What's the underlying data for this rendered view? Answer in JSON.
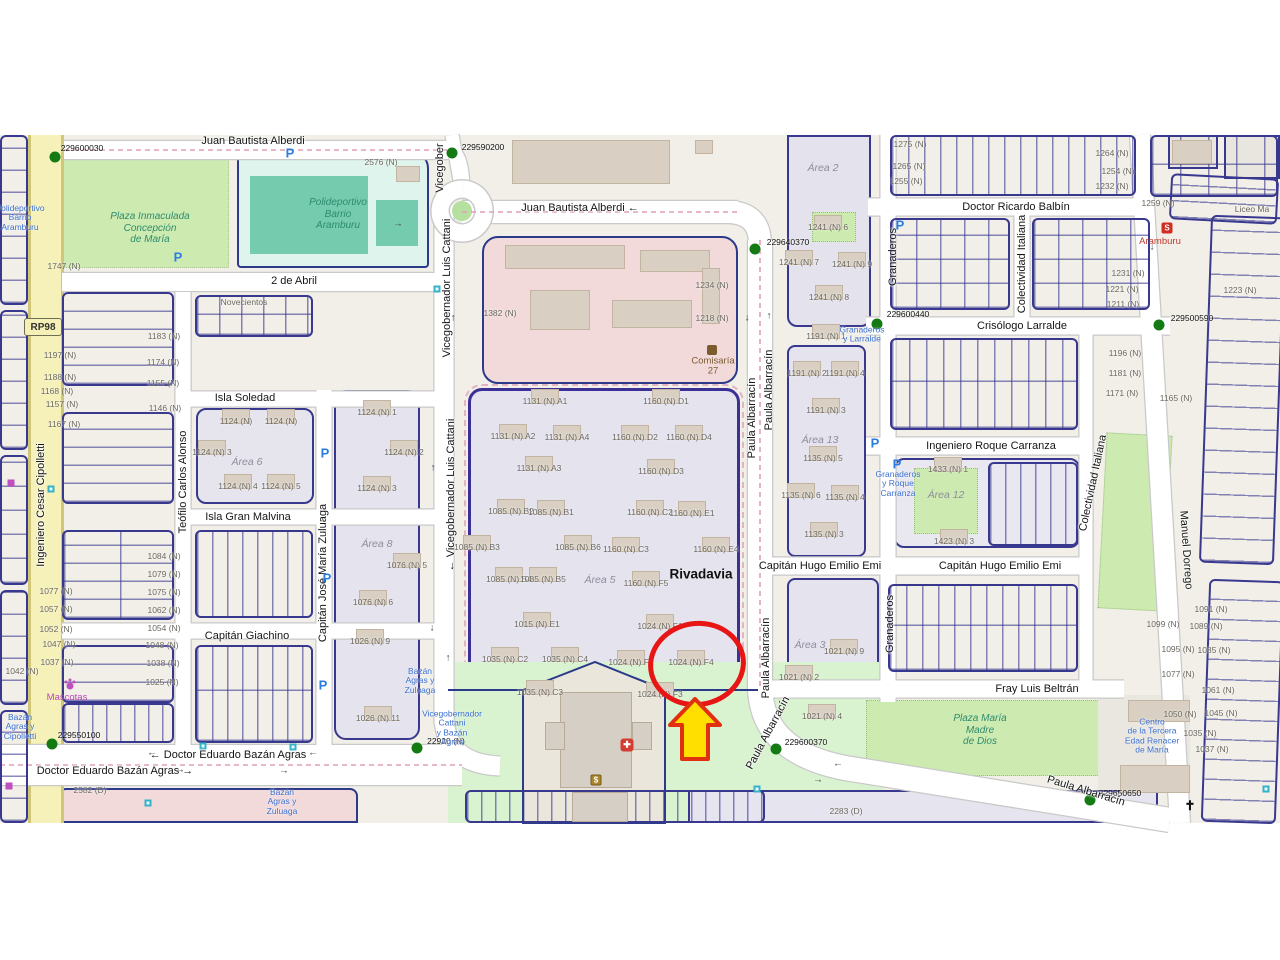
{
  "map": {
    "route_ref": "RP98",
    "highlighted_parcel": "1024 (N) F4",
    "colors": {
      "highlight_red": "#e81515",
      "arrow_yellow": "#ffdf00",
      "arrow_border": "#e03010",
      "marker_green": "#147a14",
      "bus_blue": "#3a6fd0",
      "park_green": "#cdebb0",
      "cadastral_navy": "#39388f",
      "road_yellow": "#f5f1b8"
    }
  },
  "labels": {
    "streets": [
      {
        "t": "Juan Bautista Alberdi",
        "x": 253,
        "y": 141
      },
      {
        "t": "Juan Bautista Alberdi ←",
        "x": 580,
        "y": 208
      },
      {
        "t": "2 de Abril",
        "x": 294,
        "y": 281
      },
      {
        "t": "Isla Soledad",
        "x": 245,
        "y": 398
      },
      {
        "t": "Isla Gran Malvina",
        "x": 248,
        "y": 517
      },
      {
        "t": "Capitán Giachino",
        "x": 247,
        "y": 636
      },
      {
        "t": "← Doctor Eduardo Bazán Agras",
        "x": 228,
        "y": 755
      },
      {
        "t": "Doctor Eduardo Bazán Agras →",
        "x": 115,
        "y": 771
      },
      {
        "t": "Doctor Ricardo Balbín",
        "x": 1016,
        "y": 207
      },
      {
        "t": "Crisólogo Larralde",
        "x": 1022,
        "y": 326
      },
      {
        "t": "Ingeniero Roque Carranza",
        "x": 991,
        "y": 446
      },
      {
        "t": "Capitán Hugo Emilio Emi",
        "x": 820,
        "y": 566
      },
      {
        "t": "Capitán Hugo Emilio Emi",
        "x": 1000,
        "y": 566
      },
      {
        "t": "Fray Luis Beltrán",
        "x": 1037,
        "y": 689
      },
      {
        "t": "Vicegober",
        "x": 440,
        "y": 168,
        "r": -90
      },
      {
        "t": "Vicegobernador Luis Cattani",
        "x": 447,
        "y": 288,
        "r": -90
      },
      {
        "t": "← Vicegobernador Luis Cattani",
        "x": 451,
        "y": 495,
        "r": -90
      },
      {
        "t": "Teófilo Carlos Alonso",
        "x": 183,
        "y": 482,
        "r": -90
      },
      {
        "t": "Capitán José María Zuluaga",
        "x": 323,
        "y": 573,
        "r": -90
      },
      {
        "t": "Paula Albarracín",
        "x": 752,
        "y": 418,
        "r": -90
      },
      {
        "t": "Paula Albarracín",
        "x": 769,
        "y": 390,
        "r": -90
      },
      {
        "t": "Paula Albarracín",
        "x": 766,
        "y": 658,
        "r": -90
      },
      {
        "t": "Paula Albarracín",
        "x": 768,
        "y": 733,
        "r": -62
      },
      {
        "t": "Paula Albarracín",
        "x": 1086,
        "y": 791,
        "r": 17
      },
      {
        "t": "Granaderos",
        "x": 893,
        "y": 257,
        "r": -90
      },
      {
        "t": "Granaderos",
        "x": 890,
        "y": 624,
        "r": -90
      },
      {
        "t": "Colectividad Italiana",
        "x": 1022,
        "y": 264,
        "r": -90
      },
      {
        "t": "Colectividad Italiana",
        "x": 1093,
        "y": 483,
        "r": -78
      },
      {
        "t": "Manuel Dorrego",
        "x": 1186,
        "y": 550,
        "r": 86
      },
      {
        "t": "Ingeniero Cesar Cipolletti",
        "x": 41,
        "y": 505,
        "r": -90
      }
    ],
    "minor": [
      {
        "t": "2576 (N)",
        "x": 381,
        "y": 162
      },
      {
        "t": "1747 (N)",
        "x": 64,
        "y": 266
      },
      {
        "t": "1382 (N)",
        "x": 500,
        "y": 313
      },
      {
        "t": "1234 (N)",
        "x": 712,
        "y": 285
      },
      {
        "t": "1218 (N)",
        "x": 712,
        "y": 318
      },
      {
        "t": "1275 (N)",
        "x": 910,
        "y": 144
      },
      {
        "t": "1265 (N)",
        "x": 909,
        "y": 166
      },
      {
        "t": "1255 (N)",
        "x": 906,
        "y": 181
      },
      {
        "t": "1264 (N)",
        "x": 1112,
        "y": 153
      },
      {
        "t": "1254 (N)",
        "x": 1118,
        "y": 171
      },
      {
        "t": "1232 (N)",
        "x": 1112,
        "y": 186
      },
      {
        "t": "1259 (N)",
        "x": 1158,
        "y": 203
      },
      {
        "t": "1241 (N) 6",
        "x": 828,
        "y": 227,
        "b": 1
      },
      {
        "t": "1241 (N) 7",
        "x": 799,
        "y": 262,
        "b": 1
      },
      {
        "t": "1241 (N) 9",
        "x": 852,
        "y": 264,
        "b": 1
      },
      {
        "t": "1241 (N) 8",
        "x": 829,
        "y": 297,
        "b": 1
      },
      {
        "t": "1231 (N)",
        "x": 1128,
        "y": 273
      },
      {
        "t": "1221 (N)",
        "x": 1122,
        "y": 289
      },
      {
        "t": "1223 (N)",
        "x": 1240,
        "y": 290
      },
      {
        "t": "1211 (N)",
        "x": 1123,
        "y": 304
      },
      {
        "t": "1196 (N)",
        "x": 1125,
        "y": 353
      },
      {
        "t": "1181 (N)",
        "x": 1125,
        "y": 373
      },
      {
        "t": "1171 (N)",
        "x": 1122,
        "y": 393
      },
      {
        "t": "1165 (N)",
        "x": 1176,
        "y": 398
      },
      {
        "t": "1197 (N)",
        "x": 60,
        "y": 355
      },
      {
        "t": "1188 (N)",
        "x": 60,
        "y": 377
      },
      {
        "t": "1168 (N)",
        "x": 57,
        "y": 391
      },
      {
        "t": "1157 (N)",
        "x": 62,
        "y": 404
      },
      {
        "t": "1167 (N)",
        "x": 64,
        "y": 424
      },
      {
        "t": "1183 (N)",
        "x": 164,
        "y": 336
      },
      {
        "t": "1174 (N)",
        "x": 163,
        "y": 362
      },
      {
        "t": "1155 (N)",
        "x": 163,
        "y": 383
      },
      {
        "t": "1146 (N)",
        "x": 165,
        "y": 408
      },
      {
        "t": "1077 (N)",
        "x": 56,
        "y": 591
      },
      {
        "t": "1057 (N)",
        "x": 56,
        "y": 609
      },
      {
        "t": "1052 (N)",
        "x": 56,
        "y": 629
      },
      {
        "t": "1047 (N)",
        "x": 59,
        "y": 644
      },
      {
        "t": "1037 (N)",
        "x": 57,
        "y": 662
      },
      {
        "t": "1042 (N)",
        "x": 22,
        "y": 671
      },
      {
        "t": "1084 (N)",
        "x": 164,
        "y": 556
      },
      {
        "t": "1079 (N)",
        "x": 164,
        "y": 574
      },
      {
        "t": "1075 (N)",
        "x": 164,
        "y": 592
      },
      {
        "t": "1062 (N)",
        "x": 164,
        "y": 610
      },
      {
        "t": "1054 (N)",
        "x": 164,
        "y": 628
      },
      {
        "t": "1048 (N)",
        "x": 162,
        "y": 645
      },
      {
        "t": "1038 (N)",
        "x": 163,
        "y": 663
      },
      {
        "t": "1025 (N)",
        "x": 162,
        "y": 682
      },
      {
        "t": "Novecientos",
        "x": 244,
        "y": 302
      },
      {
        "t": "1124 (N)",
        "x": 236,
        "y": 421,
        "b": 1
      },
      {
        "t": "1124 (N)",
        "x": 281,
        "y": 421,
        "b": 1
      },
      {
        "t": "1124 (N) 3",
        "x": 212,
        "y": 452,
        "b": 1
      },
      {
        "t": "1124 (N) 4",
        "x": 238,
        "y": 486,
        "b": 1
      },
      {
        "t": "1124 (N) 5",
        "x": 281,
        "y": 486,
        "b": 1
      },
      {
        "t": "1124 (N) 1",
        "x": 377,
        "y": 412,
        "b": 1
      },
      {
        "t": "1124 (N) 2",
        "x": 404,
        "y": 452,
        "b": 1
      },
      {
        "t": "1124 (N) 3",
        "x": 377,
        "y": 488,
        "b": 1
      },
      {
        "t": "1076 (N) 5",
        "x": 407,
        "y": 565,
        "b": 1
      },
      {
        "t": "1076 (N) 6",
        "x": 373,
        "y": 602,
        "b": 1
      },
      {
        "t": "1026 (N) 9",
        "x": 370,
        "y": 641,
        "b": 1
      },
      {
        "t": "1026 (N) 11",
        "x": 378,
        "y": 718,
        "b": 1
      },
      {
        "t": "1131 (N) A1",
        "x": 545,
        "y": 401,
        "b": 1
      },
      {
        "t": "1160 (N) D1",
        "x": 666,
        "y": 401,
        "b": 1
      },
      {
        "t": "1131 (N) A2",
        "x": 513,
        "y": 436,
        "b": 1
      },
      {
        "t": "1131 (N) A4",
        "x": 567,
        "y": 437,
        "b": 1
      },
      {
        "t": "1160 (N) D2",
        "x": 635,
        "y": 437,
        "b": 1
      },
      {
        "t": "1160 (N) D4",
        "x": 689,
        "y": 437,
        "b": 1
      },
      {
        "t": "1131 (N) A3",
        "x": 539,
        "y": 468,
        "b": 1
      },
      {
        "t": "1160 (N) D3",
        "x": 661,
        "y": 471,
        "b": 1
      },
      {
        "t": "1085 (N) B2",
        "x": 511,
        "y": 511,
        "b": 1
      },
      {
        "t": "1085 (N) B1",
        "x": 551,
        "y": 512,
        "b": 1
      },
      {
        "t": "1160 (N) C2",
        "x": 650,
        "y": 512,
        "b": 1
      },
      {
        "t": "1160 (N) E1",
        "x": 692,
        "y": 513,
        "b": 1
      },
      {
        "t": "1085 (N) B3",
        "x": 477,
        "y": 547,
        "b": 1
      },
      {
        "t": "1085 (N) B6",
        "x": 578,
        "y": 547,
        "b": 1
      },
      {
        "t": "1160 (N) C3",
        "x": 626,
        "y": 549,
        "b": 1
      },
      {
        "t": "1160 (N) E4",
        "x": 716,
        "y": 549,
        "b": 1
      },
      {
        "t": "1085 (N) B4",
        "x": 509,
        "y": 579,
        "b": 1
      },
      {
        "t": "1085 (N) B5",
        "x": 543,
        "y": 579,
        "b": 1
      },
      {
        "t": "1160 (N) F5",
        "x": 646,
        "y": 583,
        "b": 1
      },
      {
        "t": "1015 (N) E1",
        "x": 537,
        "y": 624,
        "b": 1
      },
      {
        "t": "1024 (N) F1",
        "x": 660,
        "y": 626,
        "b": 1
      },
      {
        "t": "1035 (N) C2",
        "x": 505,
        "y": 659,
        "b": 1
      },
      {
        "t": "1035 (N) C4",
        "x": 565,
        "y": 659,
        "b": 1
      },
      {
        "t": "1024 (N) F2",
        "x": 631,
        "y": 662,
        "b": 1
      },
      {
        "t": "1024 (N) F4",
        "x": 691,
        "y": 662,
        "b": 1
      },
      {
        "t": "1035 (N) C3",
        "x": 540,
        "y": 692,
        "b": 1
      },
      {
        "t": "1024 (N) F3",
        "x": 660,
        "y": 694,
        "b": 1
      },
      {
        "t": "1191 (N) 1",
        "x": 826,
        "y": 336,
        "b": 1
      },
      {
        "t": "1191 (N) 2",
        "x": 807,
        "y": 373,
        "b": 1
      },
      {
        "t": "1191 (N) 4",
        "x": 845,
        "y": 373,
        "b": 1
      },
      {
        "t": "1191 (N) 3",
        "x": 826,
        "y": 410,
        "b": 1
      },
      {
        "t": "1135 (N) 5",
        "x": 823,
        "y": 458,
        "b": 1
      },
      {
        "t": "1135 (N) 6",
        "x": 801,
        "y": 495,
        "b": 1
      },
      {
        "t": "1135 (N) 4",
        "x": 845,
        "y": 497,
        "b": 1
      },
      {
        "t": "1135 (N) 3",
        "x": 824,
        "y": 534,
        "b": 1
      },
      {
        "t": "1433 (N) 1",
        "x": 948,
        "y": 469,
        "b": 1
      },
      {
        "t": "1423 (N) 3",
        "x": 954,
        "y": 541,
        "b": 1
      },
      {
        "t": "1021 (N) 9",
        "x": 844,
        "y": 651,
        "b": 1
      },
      {
        "t": "1021 (N) 2",
        "x": 799,
        "y": 677,
        "b": 1
      },
      {
        "t": "1021 (N) 4",
        "x": 822,
        "y": 716,
        "b": 1
      },
      {
        "t": "1099 (N)",
        "x": 1163,
        "y": 624
      },
      {
        "t": "1091 (N)",
        "x": 1211,
        "y": 609
      },
      {
        "t": "1089 (N)",
        "x": 1206,
        "y": 626
      },
      {
        "t": "1095 (N)",
        "x": 1178,
        "y": 649
      },
      {
        "t": "1085 (N)",
        "x": 1214,
        "y": 650
      },
      {
        "t": "1077 (N)",
        "x": 1178,
        "y": 674
      },
      {
        "t": "1061 (N)",
        "x": 1218,
        "y": 690
      },
      {
        "t": "1050 (N)",
        "x": 1180,
        "y": 714
      },
      {
        "t": "1045 (N)",
        "x": 1221,
        "y": 713
      },
      {
        "t": "1035 (N)",
        "x": 1200,
        "y": 733
      },
      {
        "t": "1037 (N)",
        "x": 1212,
        "y": 749
      },
      {
        "t": "2283 (D)",
        "x": 846,
        "y": 811
      },
      {
        "t": "2582 (D)",
        "x": 90,
        "y": 790
      },
      {
        "t": "Liceo Ma",
        "x": 1252,
        "y": 209
      }
    ],
    "areas": [
      {
        "t": "Área 2",
        "x": 823,
        "y": 168
      },
      {
        "t": "Área 6",
        "x": 247,
        "y": 462
      },
      {
        "t": "Área 8",
        "x": 377,
        "y": 544
      },
      {
        "t": "Área 5",
        "x": 600,
        "y": 580
      },
      {
        "t": "Área 13",
        "x": 820,
        "y": 440
      },
      {
        "t": "Área 12",
        "x": 946,
        "y": 495
      },
      {
        "t": "Área 3",
        "x": 810,
        "y": 645
      }
    ],
    "towns": [
      {
        "t": "Rivadavia",
        "x": 701,
        "y": 574
      }
    ],
    "parks": [
      {
        "t": "Plaza Inmaculada\nConcepción\nde María",
        "x": 150,
        "y": 228
      },
      {
        "t": "Polideportivo\nBarrio\nAramburu",
        "x": 338,
        "y": 214
      },
      {
        "t": "Plaza María\nMadre\nde Dios",
        "x": 980,
        "y": 730
      }
    ],
    "bus": [
      {
        "t": "Polideportivo\nBarrio\nAramburu",
        "x": 20,
        "y": 218
      },
      {
        "t": "Granaderos\ny Larralde",
        "x": 862,
        "y": 335
      },
      {
        "t": "Granaderos\ny Roque\nCarranza",
        "x": 898,
        "y": 484
      },
      {
        "t": "Bazán\nAgras y\nZuluaga",
        "x": 420,
        "y": 681
      },
      {
        "t": "Vicegobernador\nCattani\ny Bazán\nAgras",
        "x": 452,
        "y": 728
      },
      {
        "t": "Bazán\nAgras y\nCipolletti",
        "x": 20,
        "y": 727
      },
      {
        "t": "Bazán\nAgras y\nZuluaga",
        "x": 282,
        "y": 802
      },
      {
        "t": "Centro\nde la Tercera\nEdad Renacer\nde María",
        "x": 1152,
        "y": 736
      }
    ],
    "pois": [
      {
        "t": "Aramburu",
        "x": 1160,
        "y": 242,
        "c": "#c0392b"
      },
      {
        "t": "Comisaría\n27",
        "x": 713,
        "y": 367,
        "c": "#7a5c2e"
      },
      {
        "t": "Mascotas",
        "x": 67,
        "y": 698,
        "c": "#bb44bb"
      }
    ],
    "picons": [
      {
        "t": "P",
        "x": 290,
        "y": 153
      },
      {
        "t": "P",
        "x": 178,
        "y": 257
      },
      {
        "t": "P",
        "x": 325,
        "y": 453
      },
      {
        "t": "P",
        "x": 327,
        "y": 578
      },
      {
        "t": "P",
        "x": 323,
        "y": 685
      },
      {
        "t": "P",
        "x": 900,
        "y": 225
      },
      {
        "t": "P",
        "x": 875,
        "y": 443
      },
      {
        "t": "P",
        "x": 897,
        "y": 464
      }
    ],
    "arrows": [
      {
        "t": "→",
        "x": 398,
        "y": 224
      },
      {
        "t": "↑",
        "x": 453,
        "y": 318
      },
      {
        "t": "↓",
        "x": 747,
        "y": 318
      },
      {
        "t": "↑",
        "x": 769,
        "y": 316
      },
      {
        "t": "↑",
        "x": 433,
        "y": 468
      },
      {
        "t": "↓",
        "x": 432,
        "y": 628
      },
      {
        "t": "↑",
        "x": 448,
        "y": 658
      },
      {
        "t": "←",
        "x": 152,
        "y": 753
      },
      {
        "t": "→",
        "x": 180,
        "y": 770
      },
      {
        "t": "←",
        "x": 313,
        "y": 753
      },
      {
        "t": "→",
        "x": 284,
        "y": 771
      },
      {
        "t": "←",
        "x": 838,
        "y": 764
      },
      {
        "t": "→",
        "x": 818,
        "y": 780
      },
      {
        "t": "↓",
        "x": 1152,
        "y": 247
      }
    ]
  },
  "markers": [
    {
      "code": "229600030",
      "dx": 55,
      "dy": 157,
      "lx": 82,
      "ly": 148
    },
    {
      "code": "229590200",
      "dx": 452,
      "dy": 153,
      "lx": 483,
      "ly": 147
    },
    {
      "code": "229640370",
      "dx": 755,
      "dy": 249,
      "lx": 788,
      "ly": 242
    },
    {
      "code": "229600440",
      "dx": 877,
      "dy": 324,
      "lx": 908,
      "ly": 314
    },
    {
      "code": "229500590",
      "dx": 1159,
      "dy": 325,
      "lx": 1192,
      "ly": 318
    },
    {
      "code": "229550100",
      "dx": 52,
      "dy": 744,
      "lx": 79,
      "ly": 735
    },
    {
      "code": "22920 (N)",
      "dx": 417,
      "dy": 748,
      "lx": 446,
      "ly": 741
    },
    {
      "code": "229600370",
      "dx": 776,
      "dy": 749,
      "lx": 806,
      "ly": 742
    },
    {
      "code": "229650650",
      "dx": 1090,
      "dy": 800,
      "lx": 1120,
      "ly": 793
    }
  ],
  "icons": [
    {
      "k": "medical",
      "x": 627,
      "y": 745,
      "g": "✚"
    },
    {
      "k": "bank",
      "x": 596,
      "y": 780,
      "g": "$"
    },
    {
      "k": "police",
      "x": 712,
      "y": 350,
      "g": ""
    },
    {
      "k": "church",
      "x": 1190,
      "y": 806,
      "g": "✝"
    },
    {
      "k": "station",
      "x": 1167,
      "y": 228,
      "g": "S"
    },
    {
      "k": "paw",
      "x": 70,
      "y": 686,
      "g": ""
    },
    {
      "k": "shop",
      "x": 11,
      "y": 483,
      "g": ""
    },
    {
      "k": "shop",
      "x": 9,
      "y": 786,
      "g": ""
    },
    {
      "k": "bus",
      "x": 203,
      "y": 746,
      "g": ""
    },
    {
      "k": "bus",
      "x": 293,
      "y": 747,
      "g": ""
    },
    {
      "k": "bus",
      "x": 148,
      "y": 803,
      "g": ""
    },
    {
      "k": "bus",
      "x": 757,
      "y": 789,
      "g": ""
    },
    {
      "k": "bus",
      "x": 437,
      "y": 289,
      "g": ""
    },
    {
      "k": "bus",
      "x": 51,
      "y": 489,
      "g": ""
    },
    {
      "k": "bus",
      "x": 1266,
      "y": 789,
      "g": ""
    }
  ]
}
